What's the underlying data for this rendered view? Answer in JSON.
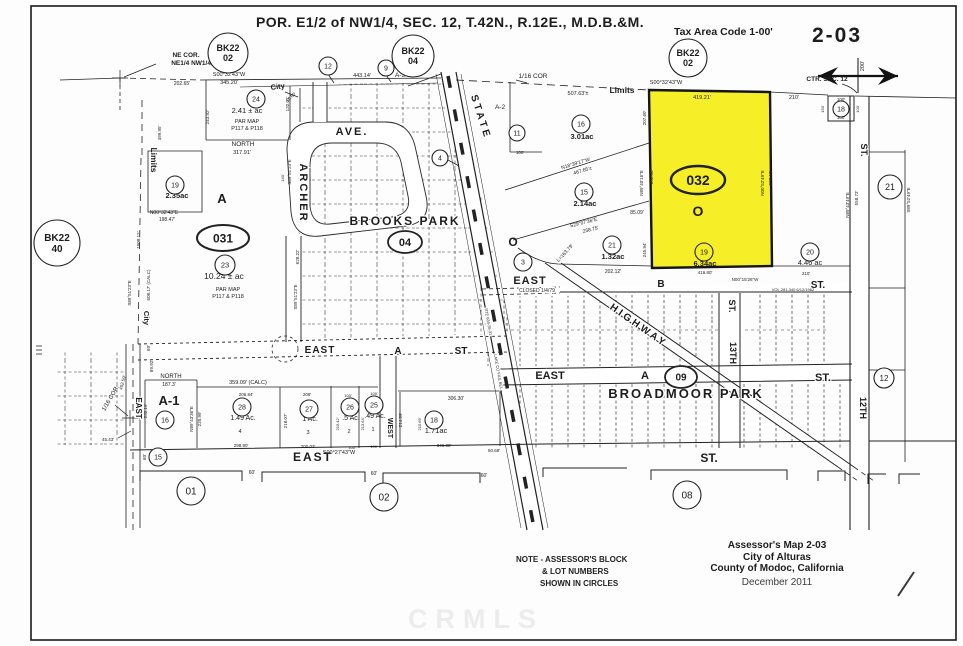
{
  "header": {
    "title": "POR. E1/2 of NW1/4,  SEC. 12,  T.42N.,  R.12E.,  M.D.B.&M.",
    "tax_area_code": "Tax Area Code 1-00'",
    "map_number": "2-03"
  },
  "footer": {
    "note_lines": [
      "NOTE - ASSESSOR'S BLOCK",
      "& LOT NUMBERS",
      "SHOWN IN CIRCLES"
    ],
    "credit_lines": [
      "Assessor's Map 2-03",
      "City of Alturas",
      "County of Modoc, California",
      "December 2011"
    ],
    "watermark": "CRMLS"
  },
  "map": {
    "highlight_color": "#f6ee26",
    "ink_color": "#1d1d1d",
    "labels": [
      {
        "t": "NE COR.",
        "x": 186,
        "y": 57,
        "s": 6.5,
        "b": 1
      },
      {
        "t": "NE1/4 NW1/4,",
        "x": 192,
        "y": 65,
        "s": 6.5,
        "b": 1
      },
      {
        "t": "202.65'",
        "x": 182,
        "y": 85,
        "s": 5
      },
      {
        "t": "S00°32'43\"W",
        "x": 229,
        "y": 76,
        "s": 5.5
      },
      {
        "t": "345.20'",
        "x": 229,
        "y": 84,
        "s": 5.5
      },
      {
        "t": "City",
        "x": 278,
        "y": 89,
        "s": 7.5,
        "b": 1,
        "r": -8
      },
      {
        "t": "10.60'",
        "x": 292,
        "y": 98,
        "s": 4.5,
        "r": -45
      },
      {
        "t": "443.14'",
        "x": 362,
        "y": 77,
        "s": 5.5
      },
      {
        "t": "A-3",
        "x": 400,
        "y": 77,
        "s": 6.5
      },
      {
        "t": "1/16 COR",
        "x": 533,
        "y": 78,
        "s": 6.5
      },
      {
        "t": "507.63'±",
        "x": 578,
        "y": 95,
        "s": 5.5
      },
      {
        "t": "Limits",
        "x": 622,
        "y": 93,
        "s": 8.5,
        "b": 1
      },
      {
        "t": "S00°32'43\"W",
        "x": 666,
        "y": 84,
        "s": 5.5
      },
      {
        "t": "419.21'",
        "x": 702,
        "y": 99,
        "s": 5.5
      },
      {
        "t": "210'",
        "x": 794,
        "y": 99,
        "s": 5.5
      },
      {
        "t": "CTR. SEC. 12",
        "x": 827,
        "y": 81,
        "s": 6.5,
        "b": 1
      },
      {
        "t": "100'",
        "x": 841,
        "y": 101,
        "s": 4.5
      },
      {
        "t": "100'",
        "x": 841,
        "y": 119,
        "s": 4.5
      },
      {
        "t": "150'",
        "x": 824,
        "y": 109,
        "s": 4,
        "r": -90
      },
      {
        "t": "100'",
        "x": 859,
        "y": 109,
        "s": 4,
        "r": -90
      },
      {
        "t": "200'",
        "x": 864,
        "y": 66,
        "s": 5.5,
        "r": -90
      },
      {
        "t": "ST.",
        "x": 861,
        "y": 150,
        "s": 9,
        "b": 1,
        "r": 90,
        "h": 1
      },
      {
        "t": "N89°43'49\"E",
        "x": 849,
        "y": 205,
        "s": 4.5,
        "r": -90
      },
      {
        "t": "558.73'",
        "x": 858,
        "y": 198,
        "s": 4.5,
        "r": -90
      },
      {
        "t": "S89°52'49\"E",
        "x": 910,
        "y": 200,
        "s": 4.5,
        "r": -90
      },
      {
        "t": "499.95'",
        "x": 161,
        "y": 133,
        "s": 4.5,
        "r": -90
      },
      {
        "t": "Limits",
        "x": 151,
        "y": 160,
        "s": 8.5,
        "b": 1,
        "r": 90
      },
      {
        "t": "City",
        "x": 144,
        "y": 318,
        "s": 7.5,
        "b": 1,
        "r": 90
      },
      {
        "t": "1508.12'",
        "x": 140,
        "y": 240,
        "s": 4.5,
        "r": -90
      },
      {
        "t": "608.17' (CALC)",
        "x": 150,
        "y": 285,
        "s": 4.5,
        "r": -90
      },
      {
        "t": "S89°51'23\"E",
        "x": 131,
        "y": 293,
        "s": 4.5,
        "r": -90
      },
      {
        "t": "NORTH",
        "x": 243,
        "y": 146,
        "s": 6.5
      },
      {
        "t": "317.91'",
        "x": 242,
        "y": 154,
        "s": 5.5
      },
      {
        "t": "243.92'",
        "x": 209,
        "y": 117,
        "s": 4.5,
        "r": -90
      },
      {
        "t": "132.01'",
        "x": 289,
        "y": 104,
        "s": 4.5,
        "r": -90
      },
      {
        "t": "2.41 ± ac",
        "x": 247,
        "y": 113,
        "s": 7.5
      },
      {
        "t": "PAR MAP",
        "x": 247,
        "y": 123,
        "s": 5.5
      },
      {
        "t": "P117 & P118",
        "x": 247,
        "y": 130,
        "s": 5.5
      },
      {
        "t": "2.35ac",
        "x": 177,
        "y": 198,
        "s": 7.5,
        "b": 1
      },
      {
        "t": "A",
        "x": 222,
        "y": 203,
        "s": 13,
        "b": 1
      },
      {
        "t": "N00°32'43\"E",
        "x": 164,
        "y": 214,
        "s": 5
      },
      {
        "t": "198.47'",
        "x": 167,
        "y": 221,
        "s": 5
      },
      {
        "t": "10.24 ± ac",
        "x": 224,
        "y": 279,
        "s": 8.5
      },
      {
        "t": "PAR MAP",
        "x": 228,
        "y": 291,
        "s": 5.5
      },
      {
        "t": "P117 & P118",
        "x": 228,
        "y": 298,
        "s": 5.5
      },
      {
        "t": "S89°51'23\"E",
        "x": 291,
        "y": 172,
        "s": 4.5,
        "r": -90
      },
      {
        "t": "140'",
        "x": 284,
        "y": 178,
        "s": 4,
        "r": -90
      },
      {
        "t": "628.22'",
        "x": 299,
        "y": 257,
        "s": 4.5,
        "r": -90
      },
      {
        "t": "S89°51'23\"E",
        "x": 297,
        "y": 297,
        "s": 4.5,
        "r": -90
      },
      {
        "t": "ARCHER",
        "x": 300,
        "y": 193,
        "s": 11,
        "b": 1,
        "r": 90,
        "ls": 2,
        "h": 1
      },
      {
        "t": "AVE.",
        "x": 352,
        "y": 135,
        "s": 11,
        "b": 1,
        "ls": 2,
        "h": 1
      },
      {
        "t": "BROOKS PARK",
        "x": 405,
        "y": 225,
        "s": 12,
        "b": 1,
        "ls": 2,
        "h": 1
      },
      {
        "t": "STATE",
        "x": 478,
        "y": 118,
        "s": 10,
        "b": 1,
        "r": 72,
        "ls": 3,
        "h": 1
      },
      {
        "t": "A-2",
        "x": 500,
        "y": 109,
        "s": 6.5
      },
      {
        "t": "100'",
        "x": 520,
        "y": 154,
        "s": 4.5
      },
      {
        "t": "RTE 634-26-31",
        "x": 487,
        "y": 322,
        "s": 4,
        "r": 80,
        "h": 1
      },
      {
        "t": "LAKE CO FILE BEL",
        "x": 497,
        "y": 372,
        "s": 4,
        "r": 80,
        "h": 1
      },
      {
        "t": "3.01ac",
        "x": 582,
        "y": 139,
        "s": 7.5,
        "b": 1
      },
      {
        "t": "N18°39'17\"W",
        "x": 576,
        "y": 165,
        "s": 5,
        "r": -17
      },
      {
        "t": "467.65'±",
        "x": 583,
        "y": 172,
        "s": 5,
        "r": -17
      },
      {
        "t": "2.14ac",
        "x": 585,
        "y": 206,
        "s": 7.5,
        "b": 1
      },
      {
        "t": "S29°07'36\"E",
        "x": 584,
        "y": 224,
        "s": 5,
        "r": -14
      },
      {
        "t": "258.75'",
        "x": 591,
        "y": 231,
        "s": 5,
        "r": -14
      },
      {
        "t": "1.32ac",
        "x": 613,
        "y": 259,
        "s": 7.5,
        "b": 1
      },
      {
        "t": "L=163.79'",
        "x": 566,
        "y": 254,
        "s": 5,
        "r": -48
      },
      {
        "t": "85.09'",
        "x": 637,
        "y": 214,
        "s": 5
      },
      {
        "t": "245.94'",
        "x": 646,
        "y": 250,
        "s": 4.5,
        "r": -90
      },
      {
        "t": "202.12'",
        "x": 613,
        "y": 273,
        "s": 5
      },
      {
        "t": "207.60'",
        "x": 646,
        "y": 118,
        "s": 4.5,
        "r": -90
      },
      {
        "t": "N89°40'16\"E",
        "x": 643,
        "y": 183,
        "s": 4.5,
        "r": -90
      },
      {
        "t": "652.08'",
        "x": 653,
        "y": 177,
        "s": 4.5,
        "r": -90
      },
      {
        "t": "O",
        "x": 698,
        "y": 216,
        "s": 14,
        "b": 1
      },
      {
        "t": "6.34ac",
        "x": 705,
        "y": 266,
        "s": 7.5,
        "b": 1
      },
      {
        "t": "416.80'",
        "x": 705,
        "y": 274,
        "s": 4.5
      },
      {
        "t": "N00°15'26\"W",
        "x": 745,
        "y": 281,
        "s": 4.5
      },
      {
        "t": "N00°52'49\"E",
        "x": 764,
        "y": 183,
        "s": 4.5,
        "r": -90
      },
      {
        "t": "603.15'",
        "x": 772,
        "y": 178,
        "s": 4.5,
        "r": -90
      },
      {
        "t": "4.46 ac",
        "x": 810,
        "y": 265,
        "s": 7.5
      },
      {
        "t": "210'",
        "x": 806,
        "y": 275,
        "s": 4.5
      },
      {
        "t": "VOL.281,340  6/12/1962",
        "x": 793,
        "y": 291,
        "s": 4
      },
      {
        "t": "O",
        "x": 513,
        "y": 246,
        "s": 12,
        "b": 1
      },
      {
        "t": "EAST",
        "x": 530,
        "y": 284,
        "s": 11,
        "b": 1,
        "ls": 1,
        "h": 1
      },
      {
        "t": "CLOSED 1/4/79",
        "x": 537,
        "y": 292,
        "s": 5,
        "h": 1
      },
      {
        "t": "B",
        "x": 661,
        "y": 287,
        "s": 10,
        "b": 1
      },
      {
        "t": "ST.",
        "x": 818,
        "y": 288,
        "s": 10,
        "b": 1
      },
      {
        "t": "HIGHWAY",
        "x": 637,
        "y": 328,
        "s": 10,
        "b": 1,
        "r": 35,
        "ls": 3,
        "h": 1
      },
      {
        "t": "13TH",
        "x": 730,
        "y": 353,
        "s": 9,
        "b": 1,
        "r": 90,
        "h": 1
      },
      {
        "t": "ST.",
        "x": 729,
        "y": 306,
        "s": 9,
        "b": 1,
        "r": 90,
        "h": 1
      },
      {
        "t": "EAST",
        "x": 550,
        "y": 379,
        "s": 11,
        "b": 1,
        "h": 1
      },
      {
        "t": "A",
        "x": 645,
        "y": 379,
        "s": 11,
        "b": 1,
        "h": 1
      },
      {
        "t": "ST.",
        "x": 823,
        "y": 381,
        "s": 11,
        "b": 1,
        "h": 1
      },
      {
        "t": "BROADMOOR PARK",
        "x": 686,
        "y": 398,
        "s": 13,
        "b": 1,
        "ls": 2,
        "h": 1
      },
      {
        "t": "12TH",
        "x": 860,
        "y": 408,
        "s": 9,
        "b": 1,
        "r": 90,
        "h": 1
      },
      {
        "t": "EAST",
        "x": 320,
        "y": 353,
        "s": 10,
        "b": 1,
        "ls": 1,
        "h": 1
      },
      {
        "t": "A",
        "x": 398,
        "y": 354,
        "s": 10,
        "b": 1,
        "h": 1
      },
      {
        "t": "ST",
        "x": 461,
        "y": 354,
        "s": 10,
        "b": 1,
        "h": 1
      },
      {
        "t": "1/16 COR.",
        "x": 112,
        "y": 399,
        "s": 6,
        "r": -60
      },
      {
        "t": "452.59'",
        "x": 124,
        "y": 383,
        "s": 4.5,
        "r": -75
      },
      {
        "t": "45.43'",
        "x": 108,
        "y": 441,
        "s": 4.5
      },
      {
        "t": "EAST",
        "x": 136,
        "y": 408,
        "s": 8,
        "b": 1,
        "r": 90,
        "h": 1
      },
      {
        "t": "60'",
        "x": 150,
        "y": 348,
        "s": 4.5,
        "r": -90
      },
      {
        "t": "89.92'",
        "x": 153,
        "y": 366,
        "s": 4.5,
        "r": -90
      },
      {
        "t": "NORTH",
        "x": 171,
        "y": 378,
        "s": 6
      },
      {
        "t": "187.3'",
        "x": 169,
        "y": 386,
        "s": 5
      },
      {
        "t": "359.09' (CALC)",
        "x": 248,
        "y": 384,
        "s": 5.5
      },
      {
        "t": "A-1",
        "x": 169,
        "y": 405,
        "s": 13,
        "b": 1
      },
      {
        "t": "232.19'",
        "x": 147,
        "y": 411,
        "s": 4.5,
        "r": -90
      },
      {
        "t": "N89°43'36\"E",
        "x": 193,
        "y": 419,
        "s": 4.5,
        "r": -90
      },
      {
        "t": "220.99'",
        "x": 201,
        "y": 419,
        "s": 4.5,
        "r": -90
      },
      {
        "t": "206.84'",
        "x": 246,
        "y": 396,
        "s": 4.5
      },
      {
        "t": "1.49 Ac.",
        "x": 243,
        "y": 420,
        "s": 7
      },
      {
        "t": "4",
        "x": 240,
        "y": 433,
        "s": 5.5
      },
      {
        "t": "218.07'",
        "x": 287,
        "y": 421,
        "s": 4.5,
        "r": -90
      },
      {
        "t": "208'",
        "x": 307,
        "y": 396,
        "s": 4.5
      },
      {
        "t": "1 Ac.",
        "x": 310,
        "y": 421,
        "s": 7
      },
      {
        "t": "3",
        "x": 308,
        "y": 434,
        "s": 5.5
      },
      {
        "t": "100'",
        "x": 348,
        "y": 397,
        "s": 4
      },
      {
        "t": ".5 Ac.",
        "x": 351,
        "y": 420,
        "s": 7
      },
      {
        "t": "2",
        "x": 349,
        "y": 433,
        "s": 5.5
      },
      {
        "t": "215.42'",
        "x": 339,
        "y": 424,
        "s": 4,
        "r": -90
      },
      {
        "t": "213.64'",
        "x": 364,
        "y": 424,
        "s": 4,
        "r": -90
      },
      {
        "t": "100'",
        "x": 374,
        "y": 395,
        "s": 4
      },
      {
        "t": ".49 Ac.",
        "x": 375,
        "y": 418,
        "s": 7
      },
      {
        "t": "1",
        "x": 373,
        "y": 431,
        "s": 5.5
      },
      {
        "t": "WEST",
        "x": 388,
        "y": 428,
        "s": 7,
        "b": 1,
        "r": 90,
        "h": 1
      },
      {
        "t": "214.89'",
        "x": 402,
        "y": 420,
        "s": 4.5,
        "r": -90
      },
      {
        "t": "215.69'",
        "x": 421,
        "y": 424,
        "s": 4,
        "r": -90
      },
      {
        "t": "306.30'",
        "x": 456,
        "y": 400,
        "s": 5
      },
      {
        "t": "1.71ac",
        "x": 436,
        "y": 433,
        "s": 7.5
      },
      {
        "t": "298.90'",
        "x": 241,
        "y": 447,
        "s": 4.5
      },
      {
        "t": "200.03'",
        "x": 308,
        "y": 448,
        "s": 4.5
      },
      {
        "t": "100'",
        "x": 352,
        "y": 449,
        "s": 4
      },
      {
        "t": "100'",
        "x": 374,
        "y": 448,
        "s": 4
      },
      {
        "t": "346.38'",
        "x": 444,
        "y": 447,
        "s": 4.5
      },
      {
        "t": "60.68'",
        "x": 494,
        "y": 452,
        "s": 4.5
      },
      {
        "t": "S00°27'43\"W",
        "x": 339,
        "y": 454,
        "s": 5.5
      },
      {
        "t": "EAST",
        "x": 313,
        "y": 461,
        "s": 12,
        "b": 1,
        "ls": 2
      },
      {
        "t": "ST.",
        "x": 709,
        "y": 462,
        "s": 12,
        "b": 1
      },
      {
        "t": "60'",
        "x": 252,
        "y": 474,
        "s": 5
      },
      {
        "t": "60'",
        "x": 374,
        "y": 475,
        "s": 5
      },
      {
        "t": "60'",
        "x": 484,
        "y": 477,
        "s": 5
      },
      {
        "t": "60'",
        "x": 146,
        "y": 457,
        "s": 4.5,
        "r": -90
      }
    ],
    "circled": [
      {
        "t": "BK22\n02",
        "x": 228,
        "y": 53,
        "rr": 20,
        "s": 9,
        "b": 1,
        "lh": 10
      },
      {
        "t": "BK22\n04",
        "x": 413,
        "y": 56,
        "rr": 21,
        "s": 9,
        "b": 1,
        "lh": 10
      },
      {
        "t": "BK22\n02",
        "x": 688,
        "y": 58,
        "rr": 19,
        "s": 9,
        "b": 1,
        "lh": 10
      },
      {
        "t": "BK22\n40",
        "x": 57,
        "y": 243,
        "rr": 23,
        "s": 10,
        "b": 1,
        "lh": 11
      },
      {
        "t": "031",
        "x": 223,
        "y": 238,
        "rx": 26,
        "ry": 13,
        "s": 12,
        "b": 1,
        "w": 2
      },
      {
        "t": "032",
        "x": 698,
        "y": 180,
        "rx": 27,
        "ry": 14,
        "s": 14,
        "b": 1,
        "w": 2.4,
        "f": "none"
      },
      {
        "t": "04",
        "x": 405,
        "y": 242,
        "rx": 17,
        "ry": 11,
        "s": 11,
        "b": 1,
        "w": 1.8
      },
      {
        "t": "09",
        "x": 681,
        "y": 377,
        "rx": 16,
        "ry": 11,
        "s": 10,
        "b": 1,
        "w": 1.8
      },
      {
        "t": "12",
        "x": 328,
        "y": 66,
        "rr": 9,
        "s": 7
      },
      {
        "t": "9",
        "x": 386,
        "y": 68,
        "rr": 8,
        "s": 7
      },
      {
        "t": "24",
        "x": 256,
        "y": 99,
        "rr": 9,
        "s": 7
      },
      {
        "t": "11",
        "x": 517,
        "y": 133,
        "rr": 8,
        "s": 7
      },
      {
        "t": "16",
        "x": 581,
        "y": 124,
        "rr": 9,
        "s": 7
      },
      {
        "t": "4",
        "x": 440,
        "y": 158,
        "rr": 8,
        "s": 7
      },
      {
        "t": "19",
        "x": 175,
        "y": 185,
        "rr": 9,
        "s": 7
      },
      {
        "t": "15",
        "x": 584,
        "y": 192,
        "rr": 9,
        "s": 7
      },
      {
        "t": "21",
        "x": 612,
        "y": 245,
        "rr": 9,
        "s": 7
      },
      {
        "t": "23",
        "x": 225,
        "y": 265,
        "rr": 10,
        "s": 7.5
      },
      {
        "t": "19",
        "x": 704,
        "y": 252,
        "rr": 9,
        "s": 7,
        "f": "none"
      },
      {
        "t": "20",
        "x": 810,
        "y": 252,
        "rr": 9,
        "s": 7
      },
      {
        "t": "18",
        "x": 841,
        "y": 109,
        "rr": 8,
        "s": 7
      },
      {
        "t": "21",
        "x": 890,
        "y": 187,
        "rr": 12,
        "s": 9
      },
      {
        "t": "3",
        "x": 523,
        "y": 262,
        "rr": 9,
        "s": 7
      },
      {
        "t": "12",
        "x": 884,
        "y": 378,
        "rr": 10,
        "s": 8
      },
      {
        "t": "16",
        "x": 165,
        "y": 420,
        "rr": 9,
        "s": 7
      },
      {
        "t": "15",
        "x": 158,
        "y": 457,
        "rr": 9,
        "s": 7
      },
      {
        "t": "28",
        "x": 242,
        "y": 407,
        "rr": 9,
        "s": 7
      },
      {
        "t": "27",
        "x": 309,
        "y": 409,
        "rr": 9,
        "s": 7
      },
      {
        "t": "26",
        "x": 350,
        "y": 407,
        "rr": 9,
        "s": 7
      },
      {
        "t": "25",
        "x": 374,
        "y": 405,
        "rr": 9,
        "s": 7
      },
      {
        "t": "18",
        "x": 434,
        "y": 420,
        "rr": 9,
        "s": 7
      },
      {
        "t": "01",
        "x": 191,
        "y": 491,
        "rr": 14,
        "s": 10
      },
      {
        "t": "02",
        "x": 384,
        "y": 497,
        "rr": 14,
        "s": 10
      },
      {
        "t": "08",
        "x": 687,
        "y": 495,
        "rr": 14,
        "s": 10
      }
    ]
  }
}
